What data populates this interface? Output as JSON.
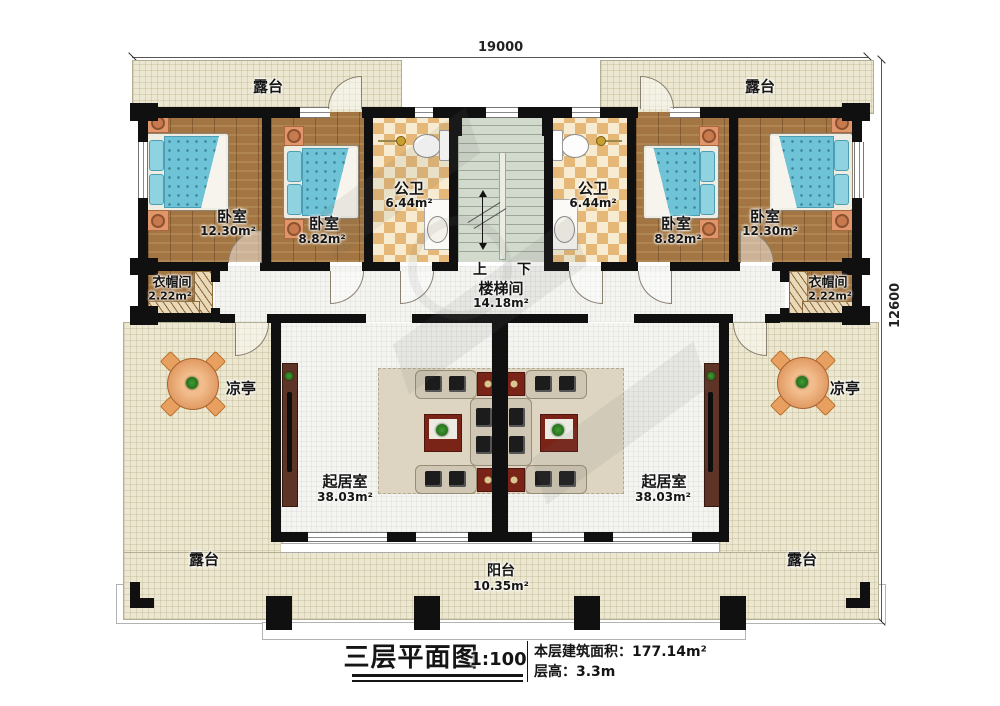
{
  "title_block": {
    "title": "三层平面图",
    "scale": "1:100",
    "area_line": "本层建筑面积：177.14m²",
    "height_line": "层高：3.3m"
  },
  "dimensions": {
    "top": "19000",
    "right": "12600"
  },
  "rooms": {
    "terrace_top_left": {
      "name": "露台"
    },
    "terrace_top_right": {
      "name": "露台"
    },
    "terrace_bottom_left": {
      "name": "露台"
    },
    "terrace_bottom_right": {
      "name": "露台"
    },
    "balcony": {
      "name": "阳台",
      "area": "10.35m²"
    },
    "bedroom_left_outer": {
      "name": "卧室",
      "area": "12.30m²"
    },
    "bedroom_left_inner": {
      "name": "卧室",
      "area": "8.82m²"
    },
    "bath_left": {
      "name": "公卫",
      "area": "6.44m²"
    },
    "bath_right": {
      "name": "公卫",
      "area": "6.44m²"
    },
    "bedroom_right_inner": {
      "name": "卧室",
      "area": "8.82m²"
    },
    "bedroom_right_outer": {
      "name": "卧室",
      "area": "12.30m²"
    },
    "cloak_left": {
      "name": "衣帽间",
      "area": "2.22m²"
    },
    "cloak_right": {
      "name": "衣帽间",
      "area": "2.22m²"
    },
    "stairwell": {
      "name": "楼梯间",
      "area": "14.18m²",
      "up": "上",
      "down": "下"
    },
    "living_left": {
      "name": "起居室",
      "area": "38.03m²"
    },
    "living_right": {
      "name": "起居室",
      "area": "38.03m²"
    },
    "pavilion_left": {
      "name": "凉亭"
    },
    "pavilion_right": {
      "name": "凉亭"
    }
  },
  "colors": {
    "wall": "#101010",
    "wood_floor": "#a27542",
    "bath_checker": "#e5b877",
    "bed_blanket": "#6fc3d6",
    "terrace_floor": "#ece7d0",
    "stair_floor": "#d2d9cd",
    "carpet": "#ddd5c2",
    "table_accent": "#7a2418",
    "pavilion_table": "#d98a50"
  }
}
